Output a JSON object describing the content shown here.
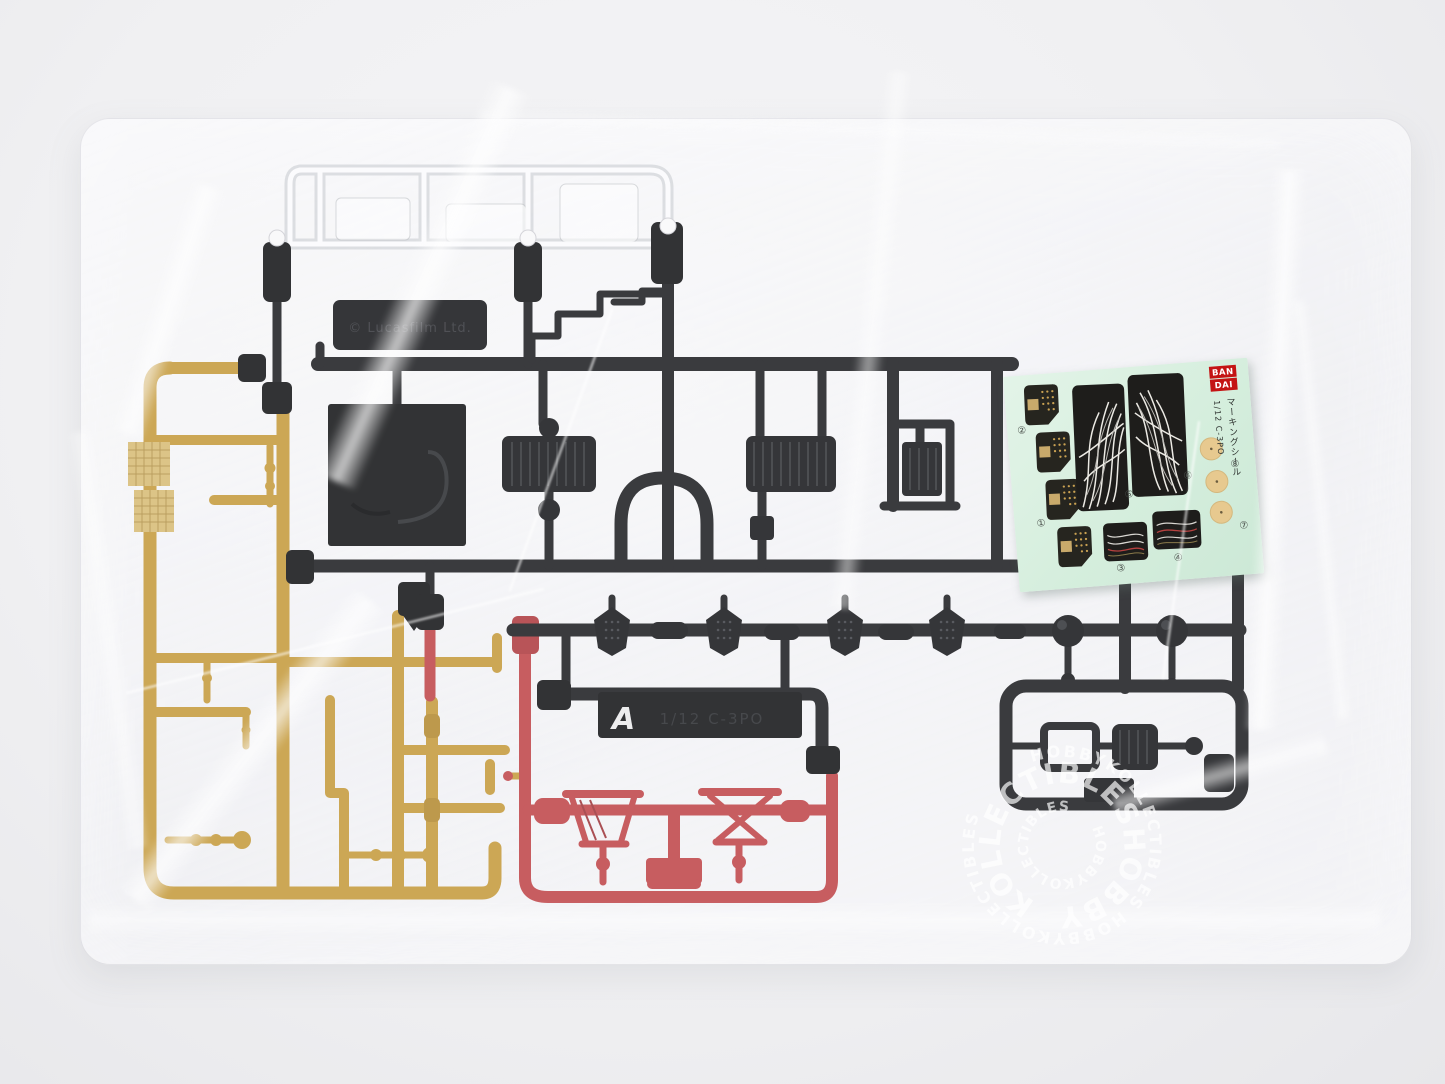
{
  "scene": {
    "subject": "Model kit runner parts sealed in a clear plastic bag with marking sticker sheet",
    "colors": {
      "backdrop": "#f0f0f2",
      "black_plastic": "#1d1e20",
      "gold_plastic": "#c79d3e",
      "red_plastic": "#c1484b",
      "clear_plastic": "#ffffff",
      "sticker_sheet_green": "#d7eedd",
      "sticker_tan": "#e7c98f",
      "bandai_red": "#c41414"
    }
  },
  "black_sprue": {
    "copyright_text": "© Lucasfilm Ltd.",
    "gate_letter": "A",
    "part_number": "1/12 C-3PO"
  },
  "sticker_sheet": {
    "brand_top": "BAN",
    "brand_bottom": "DAI",
    "title_vertical": "マーキングシール",
    "scale_label": "1/12 C-3PO",
    "numbers": {
      "n1": "①",
      "n2": "②",
      "n3": "③",
      "n4": "④",
      "n5": "⑤",
      "n6": "⑥",
      "n7": "⑦",
      "n8": "⑧"
    }
  },
  "watermark": {
    "text": "HOBBYKOLLECTIBLES",
    "ring_outer": "HOBBYKOLLECTIBLES HOBBYKOLLECTIBLES",
    "ring_middle": "KOLLECTIBLESHOBBY",
    "ring_inner": "HOBBYKOLLECTIBLES"
  }
}
